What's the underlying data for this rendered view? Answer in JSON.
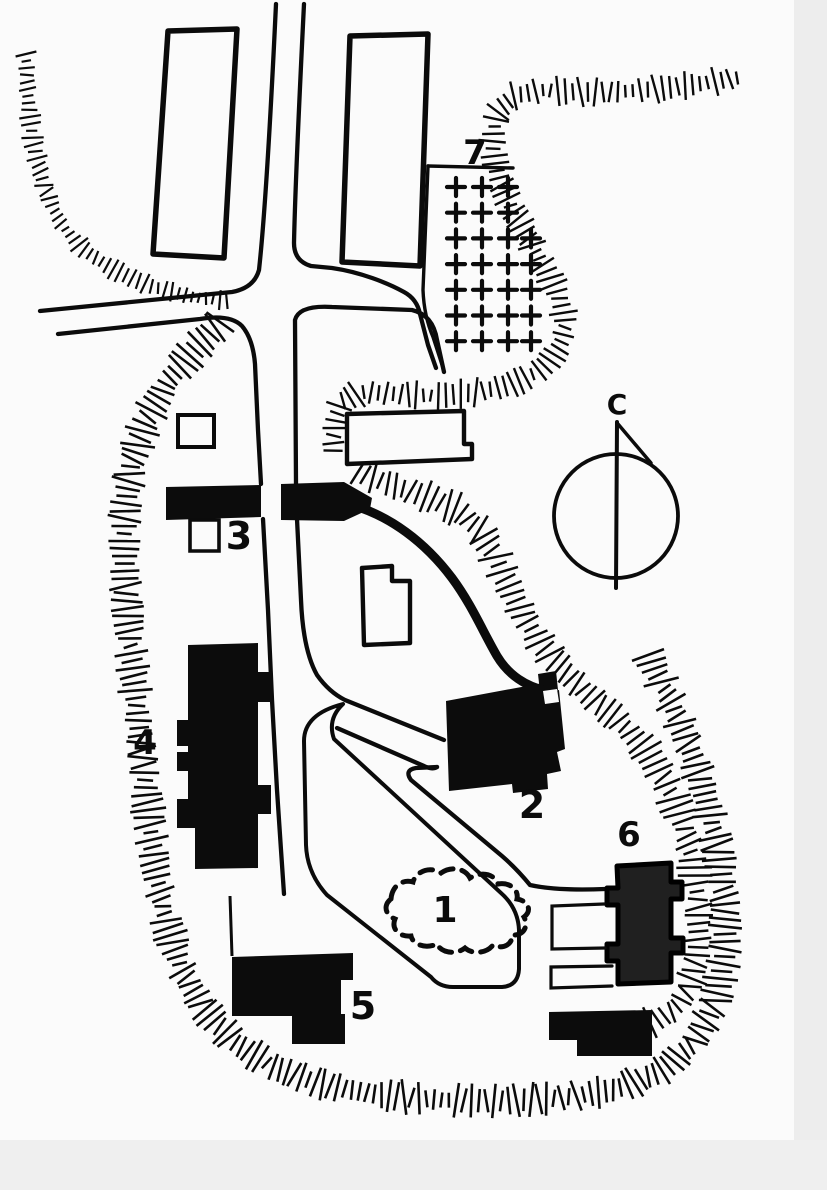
{
  "map": {
    "labels": {
      "feature_1": "1",
      "feature_2": "2",
      "feature_3": "3",
      "feature_4": "4",
      "feature_5": "5",
      "feature_6": "6",
      "feature_7": "7",
      "compass": "C"
    },
    "cemetery_area_7": {
      "rows_of_crosses": [
        3,
        3,
        4,
        4,
        4,
        4,
        4
      ]
    },
    "colors": {
      "ink": "#0b0b0b",
      "paper": "#fbfbfb",
      "building_fill": "#0c0c0c",
      "building6_fill": "#202020",
      "scan_margin": "#ececec"
    }
  }
}
